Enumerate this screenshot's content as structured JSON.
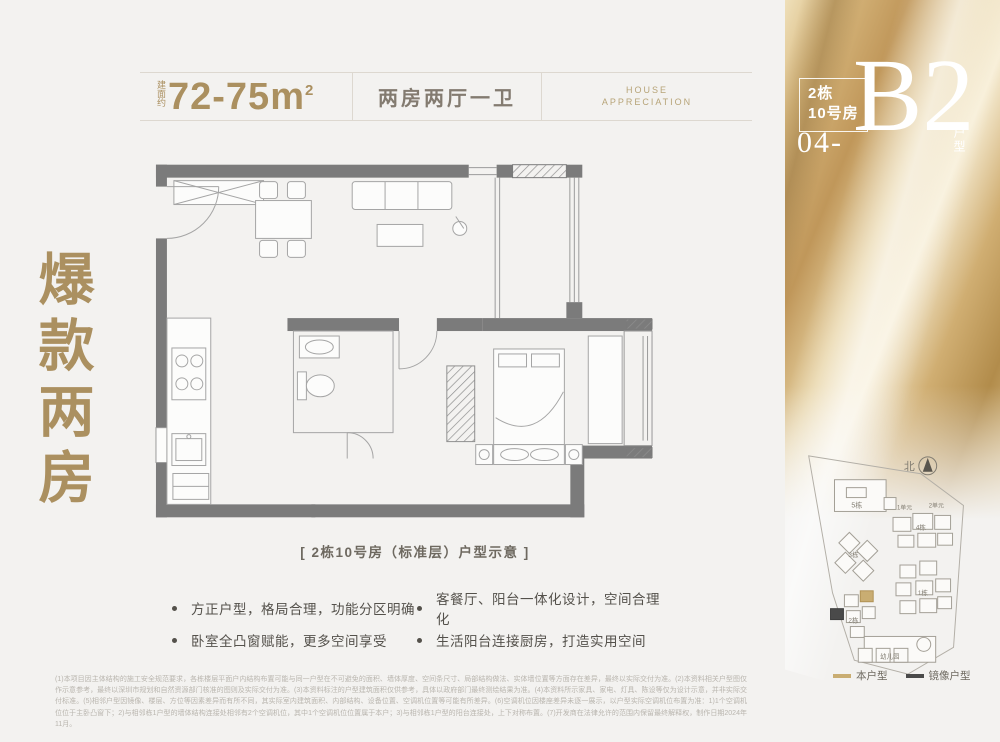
{
  "page": {
    "background": "#f3f2f0"
  },
  "side_title": "爆款两房",
  "header": {
    "area_prefix": "建面约",
    "area_value": "72-75m",
    "area_sup": "2",
    "layout": "两房两厅一卫",
    "brand_line1": "HOUSE",
    "brand_line2": "APPRECIATION"
  },
  "unit_badge": {
    "building": "2栋",
    "room": "10号房",
    "number": "04-",
    "code": "B2",
    "suffix": "户型"
  },
  "floorplan": {
    "caption": "[ 2栋10号房（标准层）户型示意 ]"
  },
  "features": [
    "方正户型，格局合理，功能分区明确",
    "卧室全凸窗赋能，更多空间享受",
    "客餐厅、阳台一体化设计，空间合理化",
    "生活阳台连接厨房，打造实用空间"
  ],
  "siteplan": {
    "north_label": "北",
    "labels": {
      "b5": "5栋",
      "u1": "1单元",
      "u2": "2单元",
      "b4": "4栋",
      "b3": "3栋",
      "b2": "2栋",
      "b1": "1栋",
      "kg": "幼儿园"
    },
    "legend": [
      {
        "label": "本户型",
        "color": "#c9ad72"
      },
      {
        "label": "镜像户型",
        "color": "#4a4a4a"
      }
    ]
  },
  "disclaimer": "(1)本项目因主体结构的施工安全规范要求，各栋楼层平面户内结构布置可能与同一户型在不可避免的面积、墙体厚度、空间条尺寸、局部结构做法、实体墙位置等方面存在差异，最终以实际交付为准。(2)本资料相关户型图仅作示意参考，最终以深圳市规划和自然资源部门核准的图则及实际交付为准。(3)本资料标注的户型建筑面积仅供参考，具体以政府部门最终测绘结果为准。(4)本资料所示家具、家电、灯具、陈设等仅为设计示意，并非实际交付标准。(5)相邻户型因镜像、楼层、方位等因素差异而有所不同，其实际室内建筑面积、内部结构、设备位置、空调机位置等可能有所差异。(6)空调机位因楼座差异未逐一展示，以户型实际空调机位布置为准：1)1个空调机位位于主卧凸窗下；2)与相邻栋1户型的墙体结构连接处相邻有2个空调机位，其中1个空调机位位置属于本户；3)与相邻栋1户型的阳台连接处，上下对称布置。(7)开发商在法律允许的范围内保留最终解释权，制作日期2024年11月。",
  "colors": {
    "gold_text": "#ab9060",
    "wall": "#7b7b7b",
    "highlight_gold": "#c9ad72",
    "mirror_dark": "#4a4a4a"
  }
}
